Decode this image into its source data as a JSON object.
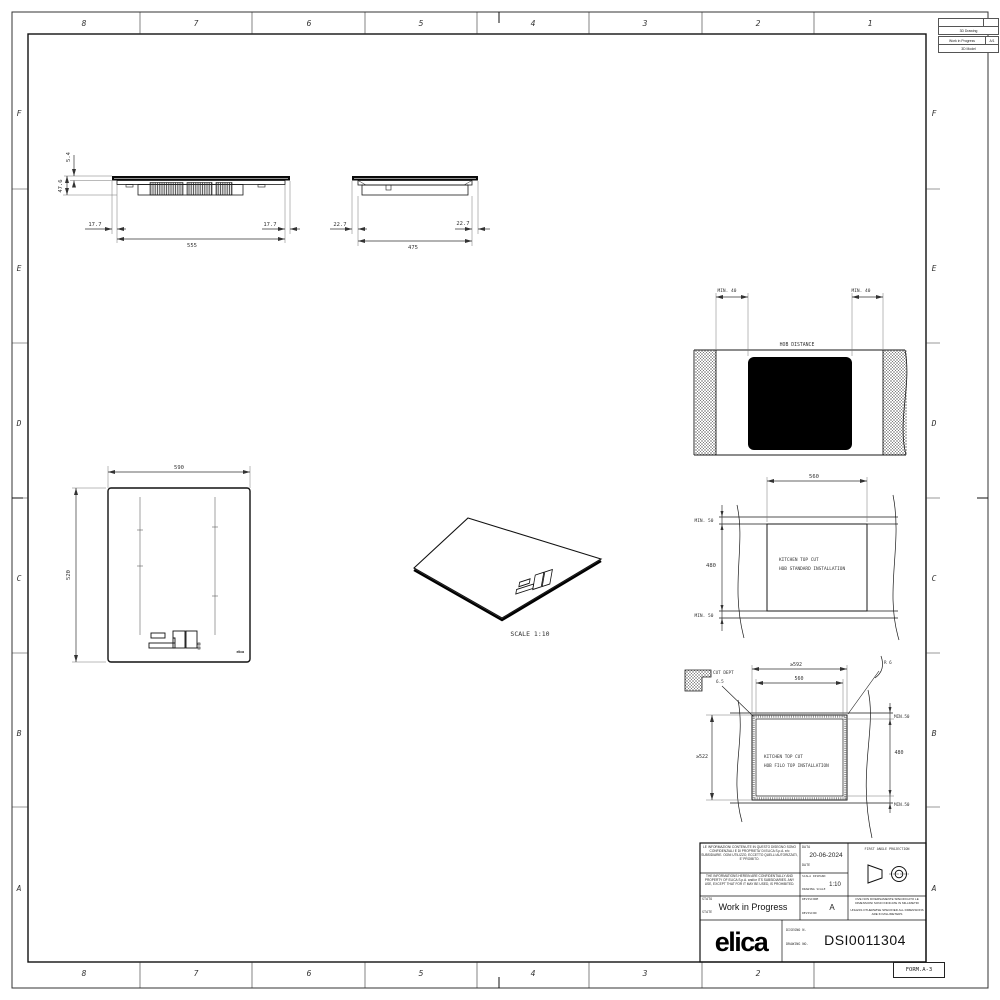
{
  "sheet": {
    "zones_top": [
      "8",
      "7",
      "6",
      "5",
      "4",
      "3",
      "2",
      "1"
    ],
    "zones_bottom": [
      "8",
      "7",
      "6",
      "5",
      "4",
      "3",
      "2"
    ],
    "zones_side": [
      "F",
      "E",
      "D",
      "C",
      "B",
      "A"
    ],
    "form_label": "FORM.A-3"
  },
  "revision_table": {
    "doc_type": "3D Drawing",
    "status": "Work in Progress",
    "sheet_ref": "A/1",
    "model_type": "3D Model"
  },
  "side_view_front": {
    "glass_thickness": "5.4",
    "total_height": "47.6",
    "overhang_left": "17.7",
    "body_width": "555",
    "overhang_right": "17.7"
  },
  "side_view_side": {
    "overhang_left": "22.7",
    "body_depth": "475",
    "overhang_right": "22.7"
  },
  "top_view": {
    "width": "590",
    "depth": "520",
    "brand": "elica"
  },
  "iso_view": {
    "scale_label": "SCALE 1:10"
  },
  "hob_distance": {
    "title": "HOB DISTANCE",
    "min_left": "MIN. 40",
    "min_right": "MIN. 40"
  },
  "standard_cut": {
    "cut_width": "560",
    "cut_depth": "480",
    "min_back": "MIN. 50",
    "min_front": "MIN. 50",
    "label_line1": "KITCHEN TOP CUT",
    "label_line2": "HOB STANDARD INSTALLATION"
  },
  "flush_cut": {
    "outer_width": "≥592",
    "inner_width": "560",
    "outer_depth": "≥522",
    "inner_depth": "480",
    "corner_radius": "R 6",
    "cut_dept_label": "CUT DEPT",
    "cut_dept_value": "6.5",
    "min_back": "MIN.50",
    "min_front": "MIN.50",
    "label_line1": "KITCHEN TOP CUT",
    "label_line2": "HOB FILO TOP INSTALLATION"
  },
  "title_block": {
    "confidential_it": "LE INFORMAZIONI CONTENUTE IN QUESTO DISEGNO SONO CONFIDENZIALI E DI PROPRIETA' DI ELICA S.p.A. e/o SUBSIDIARIE. OGNI UTILIZZO, ECCETTO QUELLI AUTORIZZATI, E' PROIBITO.",
    "confidential_en": "THE INFORMATIONS HEREIN ARE CONFIDENTIALLY AND PROPERTY OF ELICA S.p.A. and/or ITS SUBSIDIARIES. ANY USE, EXCEPT THAT FOR IT MAY BE USED, IS PROHIBITED.",
    "stato_label": "STATO",
    "state_label": "STATE",
    "status_value": "Work in Progress",
    "data_label": "DATA",
    "date_label": "DATE",
    "date_value": "20-06-2024",
    "scala_label": "SCALA DISEGNO",
    "scale_label": "DRAWING SCALE",
    "scale_value": "1:10",
    "revisione_label": "REVISIONE",
    "revision_label": "REVISION",
    "revision_value": "A",
    "projection_label": "FIRST ANGLE PROJECTION",
    "units_note_it": "OVE NON DIVERSAMENTE SPECIFICATO LE DIMENSIONI SONO INDICATE IN MILLIMETRI",
    "units_note_en": "UNLESS OTHERWISE SPECIFIED ALL DIMENSIONS ARE IN MILLIMETERS",
    "disegno_label": "DISEGNO N.",
    "drawing_label": "DRAWING NO.",
    "drawing_number": "DSI0011304",
    "brand": "elica"
  }
}
